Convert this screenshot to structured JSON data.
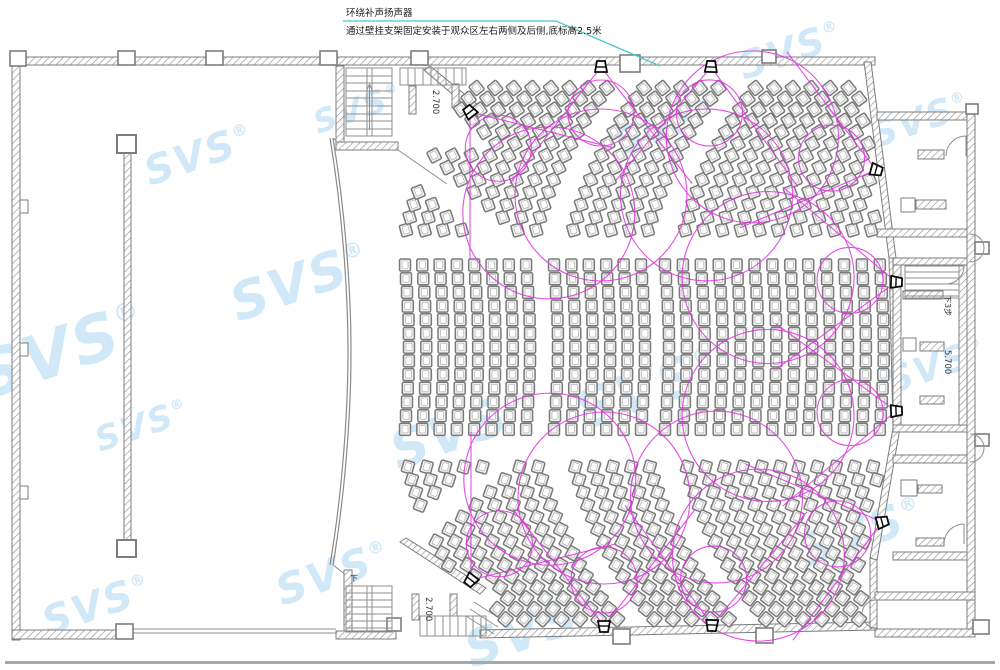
{
  "annotation": {
    "line1": "环绕补声扬声器",
    "line2": "通过壁挂支架固定安装于观众区左右两侧及后侧,底标高2.5米"
  },
  "labels": [
    {
      "name": "elevation-top-stair",
      "text": "2.700",
      "x": 433,
      "y": 90,
      "rot": 90,
      "size": 8.5
    },
    {
      "name": "elevation-bottom-stair",
      "text": "2.700",
      "x": 426,
      "y": 597,
      "rot": 90,
      "size": 8.5
    },
    {
      "name": "elevation-corridor",
      "text": "5.700",
      "x": 945,
      "y": 350,
      "rot": 90,
      "size": 8.5
    },
    {
      "name": "steps-note-corridor",
      "text": "下3步",
      "x": 945,
      "y": 295,
      "rot": 90,
      "size": 8
    },
    {
      "name": "down-note-stair",
      "text": "下",
      "x": 350,
      "y": 581,
      "rot": 0,
      "size": 8
    }
  ],
  "watermark": {
    "text": "SVS",
    "reg": "®",
    "color": "#c8e5f7",
    "items": [
      {
        "x": -14,
        "y": 400,
        "s": 64
      },
      {
        "x": 100,
        "y": 452,
        "s": 34
      },
      {
        "x": 238,
        "y": 322,
        "s": 52
      },
      {
        "x": 150,
        "y": 186,
        "s": 40
      },
      {
        "x": 318,
        "y": 134,
        "s": 32
      },
      {
        "x": 398,
        "y": 470,
        "s": 52
      },
      {
        "x": 282,
        "y": 606,
        "s": 42
      },
      {
        "x": 472,
        "y": 668,
        "s": 50
      },
      {
        "x": 584,
        "y": 430,
        "s": 54
      },
      {
        "x": 620,
        "y": 156,
        "s": 38
      },
      {
        "x": 744,
        "y": 80,
        "s": 38
      },
      {
        "x": 806,
        "y": 568,
        "s": 46
      },
      {
        "x": 892,
        "y": 394,
        "s": 36
      },
      {
        "x": 876,
        "y": 148,
        "s": 36
      },
      {
        "x": 48,
        "y": 636,
        "s": 40
      }
    ]
  },
  "colors": {
    "coverage": "#e036e0",
    "leader": "#4cc8ca",
    "wall": "#7d7d7d",
    "hatch": "#9a9a9a",
    "seat_stroke": "#7a7a7a",
    "seat_fill": "#efefef"
  },
  "speakers": [
    {
      "x": 601,
      "y": 67,
      "aim": 90
    },
    {
      "x": 711,
      "y": 67,
      "aim": 92
    },
    {
      "x": 470,
      "y": 112,
      "aim": 52
    },
    {
      "x": 876,
      "y": 170,
      "aim": 195
    },
    {
      "x": 896,
      "y": 282,
      "aim": 182
    },
    {
      "x": 896,
      "y": 411,
      "aim": 178
    },
    {
      "x": 882,
      "y": 522,
      "aim": 165
    },
    {
      "x": 604,
      "y": 626,
      "aim": 270
    },
    {
      "x": 712,
      "y": 625,
      "aim": 272
    },
    {
      "x": 471,
      "y": 580,
      "aim": 308
    }
  ],
  "coverage": {
    "small_r": 33,
    "small_d": 46,
    "large_r": 86,
    "large_d": 128,
    "cone_half_angle": 38,
    "cone_len": 148
  },
  "seating": {
    "middle": {
      "groups": [
        [
          405,
          17.3,
          8
        ],
        [
          554,
          17.4,
          6
        ],
        [
          665,
          17.9,
          13
        ]
      ],
      "y0": 265,
      "rows": 13,
      "dy": 13.7,
      "bow": 4
    },
    "top": {
      "edge_y": 230,
      "x0": 406,
      "dx": 18.6,
      "count": 26,
      "skip": [
        [
          545,
          560
        ],
        [
          655,
          672
        ]
      ],
      "theta0": 74,
      "dtheta": 1.9,
      "step": 13.3,
      "max": 14
    },
    "bottom": {
      "edge_y": 467,
      "x0": 408,
      "dx": 18.6,
      "count": 26,
      "skip": [
        [
          545,
          560
        ],
        [
          655,
          672
        ]
      ],
      "theta0": 74,
      "dtheta": 1.9,
      "step": 13.3,
      "max": 14
    },
    "seat": {
      "w": 11,
      "h": 12
    }
  }
}
